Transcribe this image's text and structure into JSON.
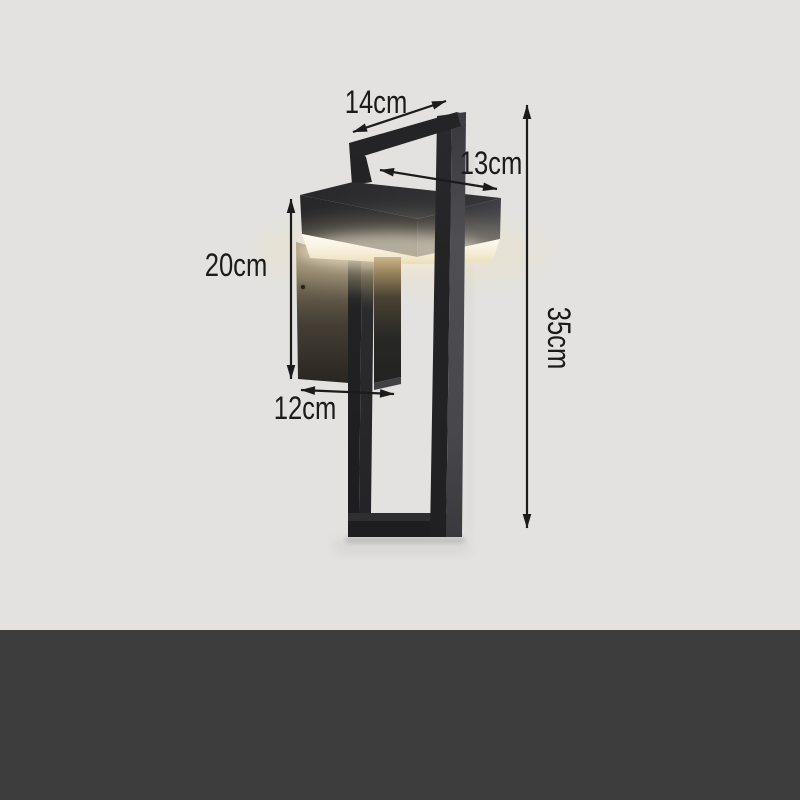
{
  "annotations": {
    "top_width": {
      "label": "14cm"
    },
    "head_depth": {
      "label": "13cm"
    },
    "body_height": {
      "label": "20cm"
    },
    "wall_offset": {
      "label": "12cm"
    },
    "total_height": {
      "label": "35cm"
    }
  },
  "colors": {
    "background": "#e3e2e0",
    "bottom_band": "#3d3d3d",
    "annotation": "#1b1b1b",
    "lamp_metal": "#232325",
    "lamp_metal_side": "#4a4a4e",
    "diffuser_glow": "#f8f1de",
    "plate_lit": "#8f8166"
  }
}
